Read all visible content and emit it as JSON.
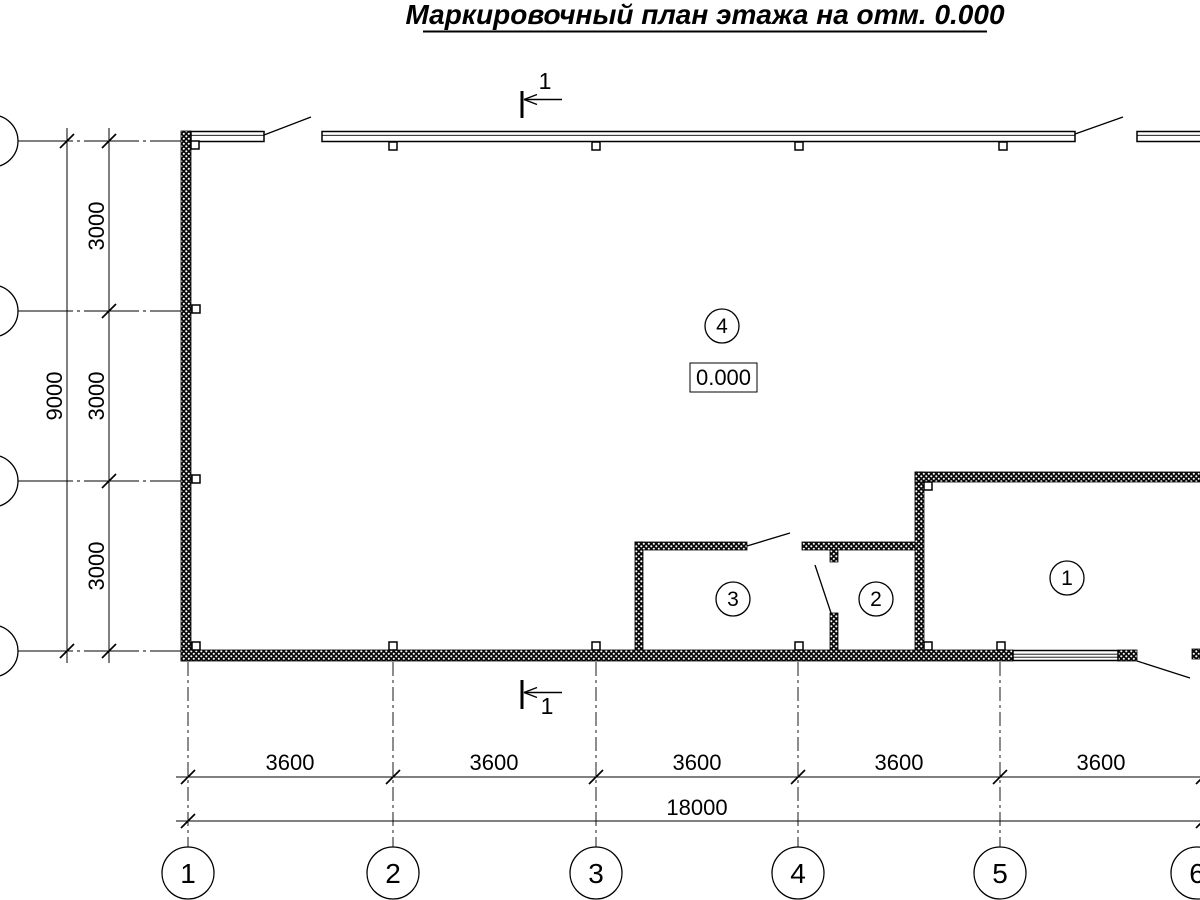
{
  "drawing": {
    "title": "Маркировочный план этажа на отм. 0.000",
    "elevation_mark": "0.000",
    "section_mark_top": "1",
    "section_mark_bottom": "1",
    "rooms": [
      {
        "number": "4"
      },
      {
        "number": "3"
      },
      {
        "number": "2"
      },
      {
        "number": "1"
      }
    ],
    "axes_columns": [
      "1",
      "2",
      "3",
      "4",
      "5",
      "6"
    ],
    "dim_left_segments": [
      "3000",
      "3000",
      "3000"
    ],
    "dim_left_total": "9000",
    "dim_bottom_segments": [
      "3600",
      "3600",
      "3600",
      "3600",
      "3600"
    ],
    "dim_bottom_total": "18000"
  }
}
